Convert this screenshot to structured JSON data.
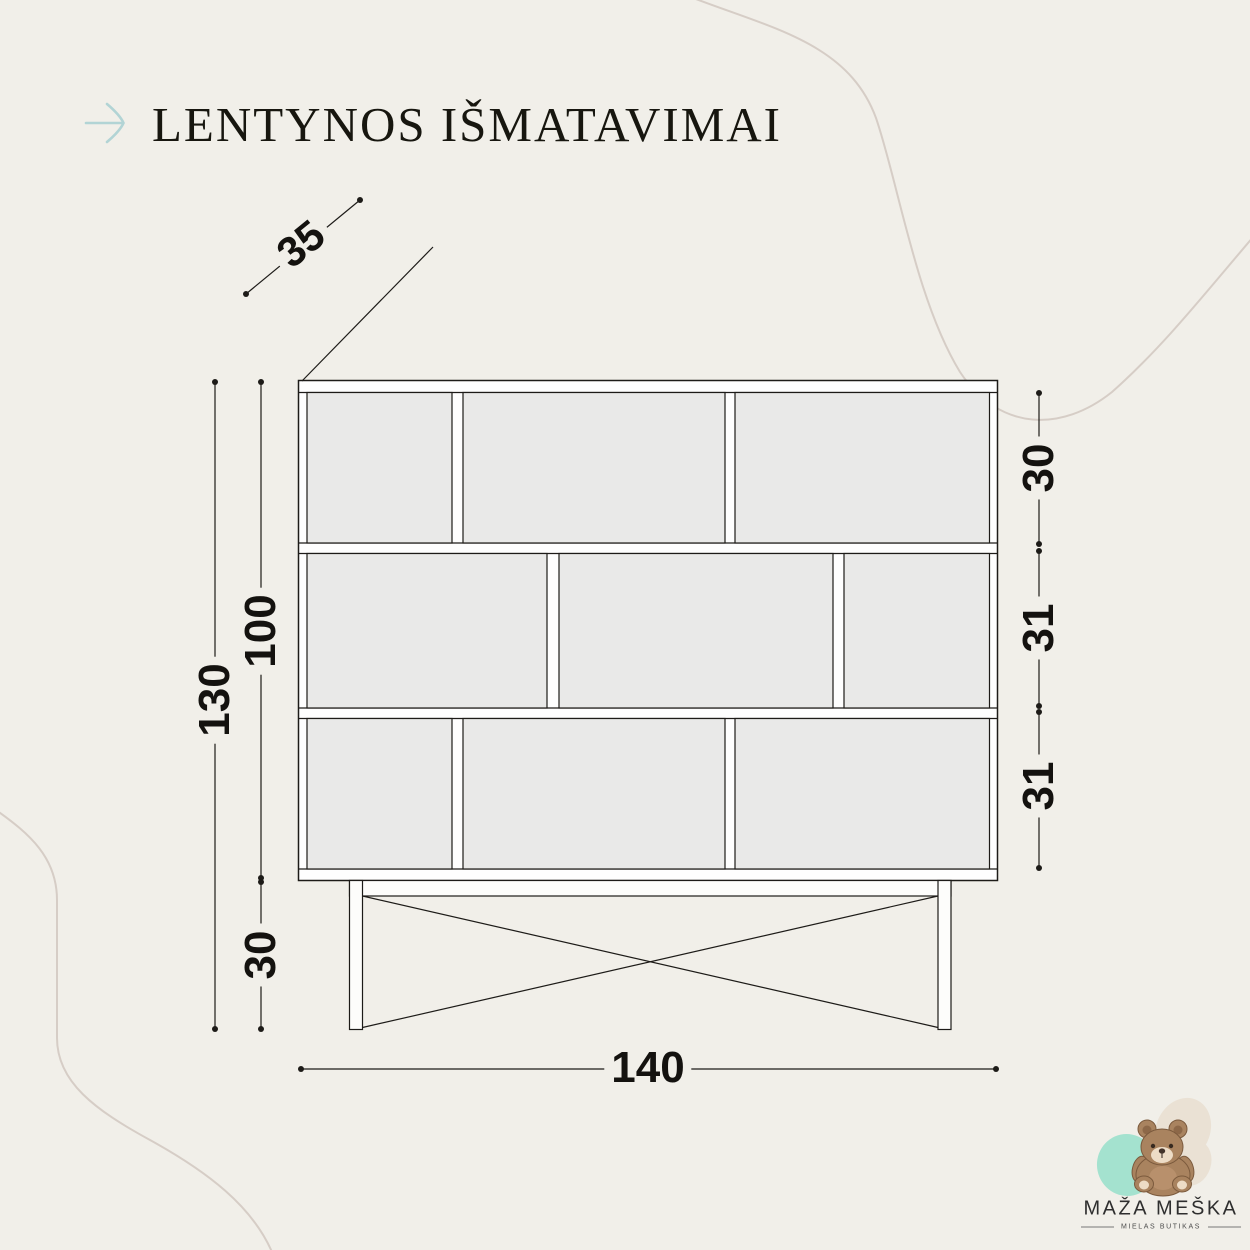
{
  "header": {
    "title": "LENTYNOS IŠMATAVIMAI",
    "arrow_icon": "arrow-right-icon"
  },
  "diagram": {
    "type": "furniture dimension drawing",
    "object": "shelf unit (lentyna), front view with depth callout",
    "units": "cm",
    "dimensions": {
      "depth": "35",
      "width": "140",
      "total_height": "130",
      "body_height": "100",
      "base_height": "30",
      "top_row_height": "30",
      "middle_row_height": "31",
      "bottom_row_height": "31"
    },
    "structure": {
      "rows": 3,
      "compartments_per_row": 3,
      "base": "two legs with X cross brace"
    }
  },
  "logo": {
    "brand": "MAŽA MEŠKA",
    "tagline": "MIELAS BUTIKAS",
    "icon": "teddy-bear-icon"
  },
  "colors": {
    "background": "#f1efe9",
    "line": "#1d1b18",
    "frame_fill": "#fefefe",
    "compartment_fill": "#e9e9e8",
    "accent_arrow": "#b2d4d5",
    "decor_curve": "#d6cdc6",
    "logo_mint": "#a4e2cf",
    "logo_beige": "#eae1d4",
    "bear_brown": "#a9835f"
  }
}
